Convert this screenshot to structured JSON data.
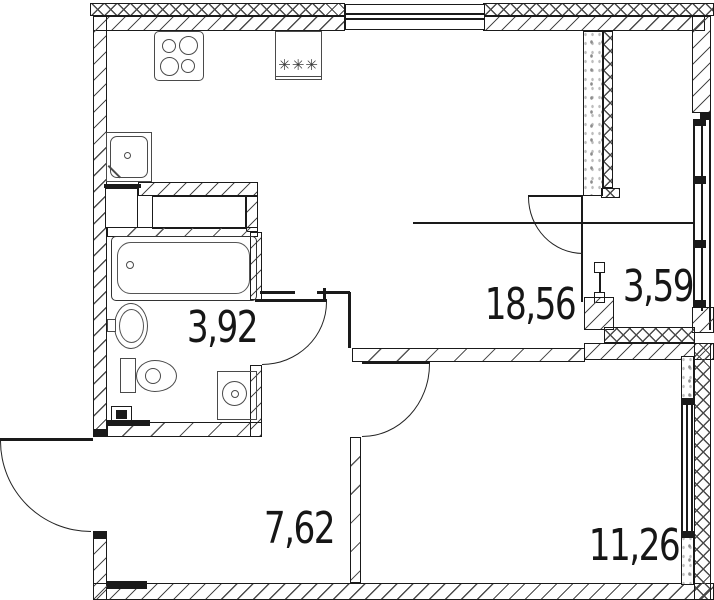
{
  "plan": {
    "rooms": [
      {
        "id": "kitchen-living-room",
        "area": "18,56"
      },
      {
        "id": "loggia",
        "area": "3,59"
      },
      {
        "id": "bathroom",
        "area": "3,92"
      },
      {
        "id": "hallway",
        "area": "7,62"
      },
      {
        "id": "bedroom",
        "area": "11,26"
      }
    ],
    "appliances": {
      "freezer_symbol": "✳✳✳"
    },
    "colors": {
      "line": "#1a1a1a",
      "wall_hatch": "#4a4a4a",
      "background": "#ffffff"
    }
  }
}
